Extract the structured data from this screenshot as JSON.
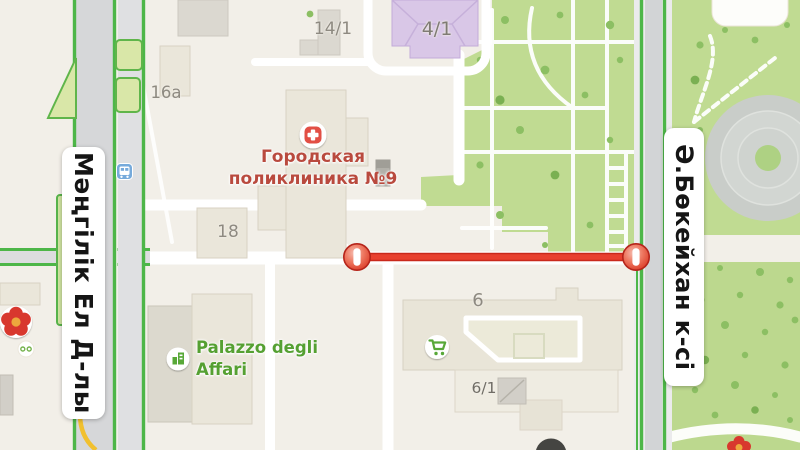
{
  "map": {
    "streets": {
      "left_vertical": "Мәңгілік Ел Д-лы",
      "right_vertical": "Ә.Бөкейхан к-сі"
    },
    "building_labels": [
      {
        "label": "14/1"
      },
      {
        "label": "4/1"
      },
      {
        "label": "16a"
      },
      {
        "label": "18"
      },
      {
        "label": "6"
      },
      {
        "label": "6/1"
      }
    ],
    "pois": {
      "polyclinic": {
        "line1": "Городская",
        "line2": "поликлиника №9",
        "icon": "hospital-icon"
      },
      "palazzo": {
        "line1": "Palazzo degli",
        "line2": "Affari",
        "icon": "office-building-icon"
      }
    },
    "closure": {
      "type": "road-closed-segment",
      "marker": "no-entry"
    },
    "icons": {
      "flower": "flower-icon",
      "bus_stop": "bus-stop-icon",
      "cart": "shopping-cart-icon"
    },
    "colors": {
      "background_beige": "#f2efe8",
      "park_green": "#c0db92",
      "tree_green": "#8cbf63",
      "road_green_line": "#4db648",
      "closure_red": "#e23728",
      "poi_red_text": "#b94a3e",
      "poi_green_text": "#55a032",
      "building_fill": "#eae6da",
      "purple_building": "#d9c7e7",
      "traffic_yellow": "#f1c02f",
      "bus_icon_blue": "#76aadb"
    }
  }
}
